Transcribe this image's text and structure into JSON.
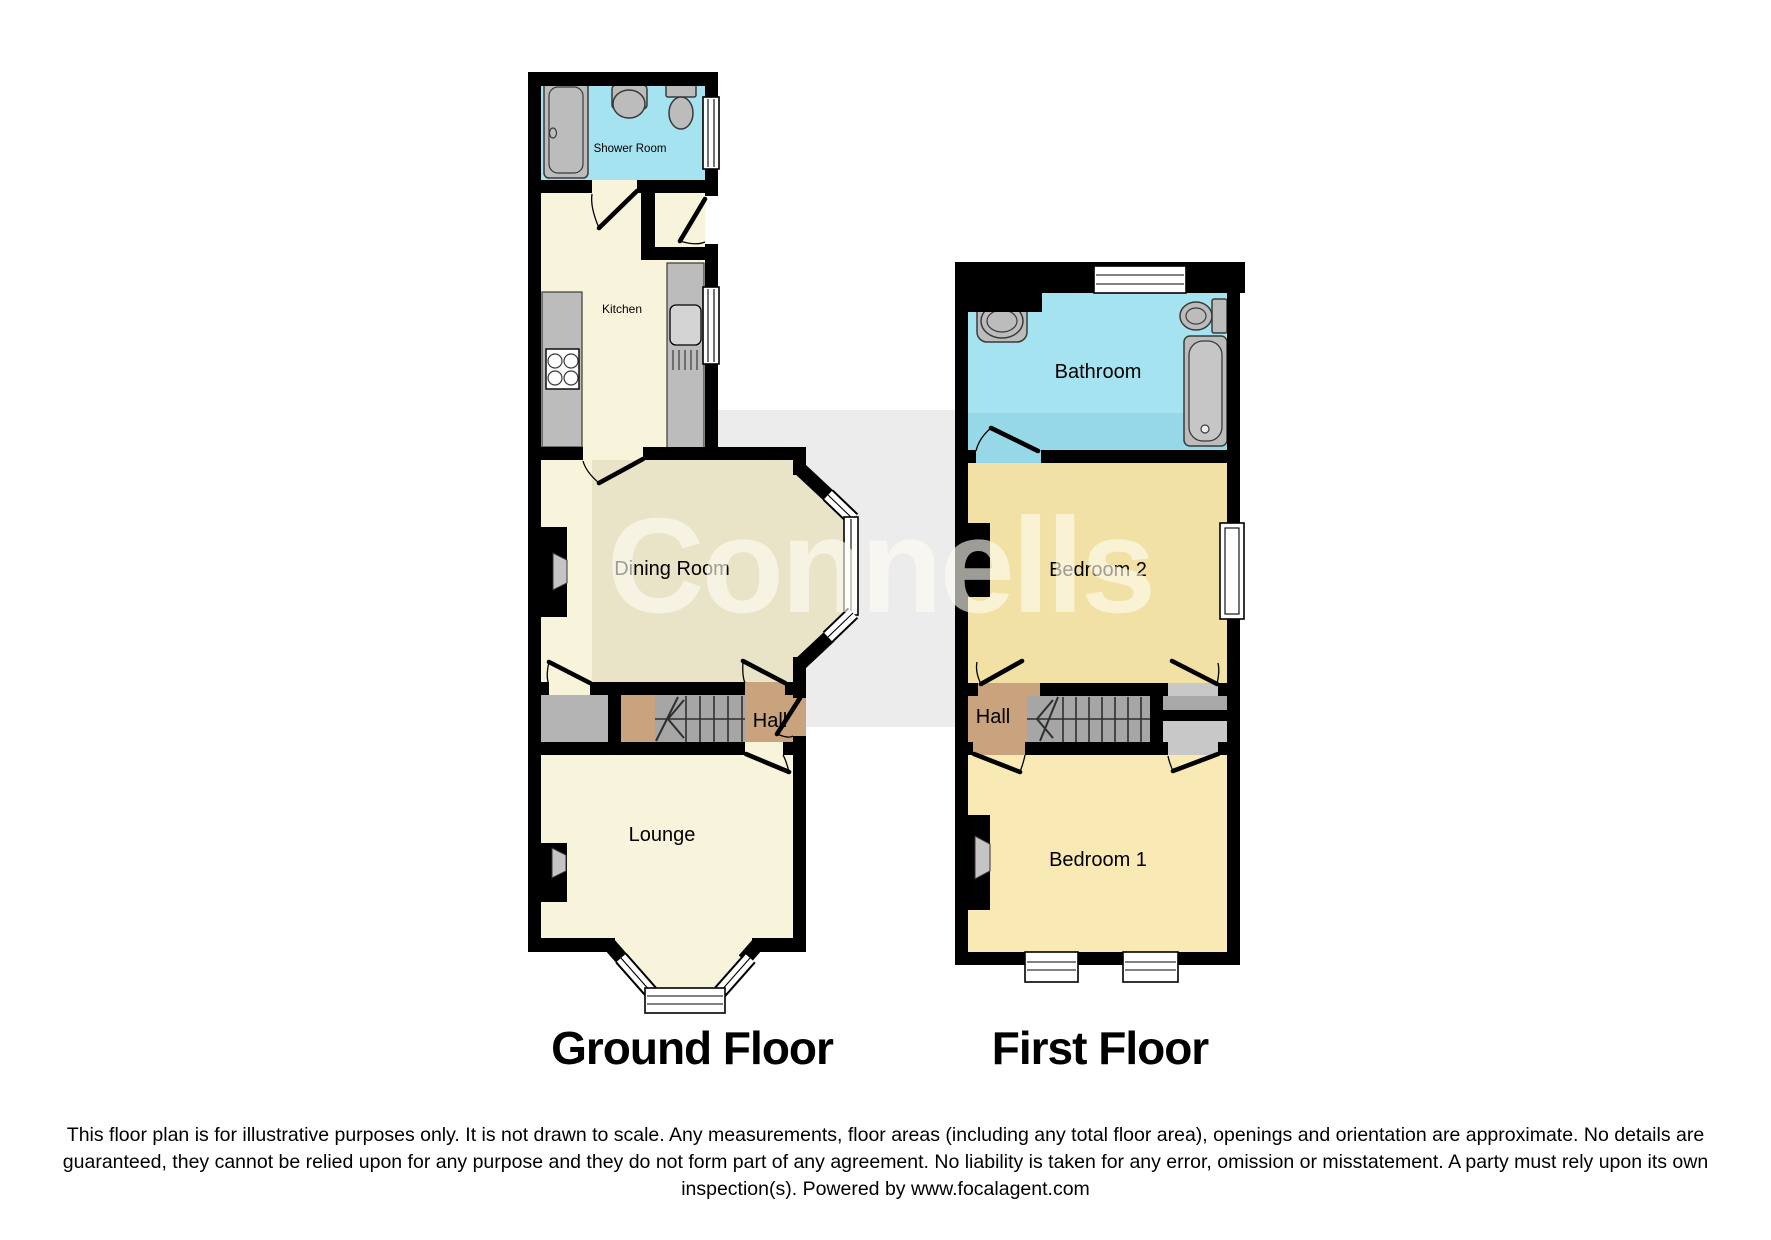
{
  "watermark": {
    "text": "Connells"
  },
  "floors": {
    "ground": {
      "title": "Ground Floor",
      "rooms": {
        "shower_room": "Shower Room",
        "kitchen": "Kitchen",
        "dining_room": "Dining Room",
        "hall": "Hall",
        "lounge": "Lounge"
      }
    },
    "first": {
      "title": "First Floor",
      "rooms": {
        "bathroom": "Bathroom",
        "bedroom2": "Bedroom 2",
        "hall": "Hall",
        "bedroom1": "Bedroom 1"
      }
    }
  },
  "fixture_icons": [
    "shower-tray",
    "basin",
    "toilet",
    "hob",
    "kitchen-sink",
    "bath",
    "stairs",
    "fireplace",
    "window",
    "door"
  ],
  "disclaimer": "This floor plan is for illustrative purposes only. It is not drawn to scale. Any measurements, floor areas (including any total floor area), openings and orientation are approximate. No details are guaranteed, they cannot be relied upon for any purpose and they do not form part of any agreement. No liability is taken for any error, omission or misstatement. A party must rely upon its own inspection(s). Powered by www.focalagent.com",
  "colors": {
    "wall": "#000000",
    "cream": "#f8f4dc",
    "khaki": "#e9e4c8",
    "cyan": "#a5e3f0",
    "cyan2": "#96d8e8",
    "bed1": "#f9e9b4",
    "bed2": "#f2e1a4",
    "tan": "#c9a37e",
    "stair": "#a6a6a6",
    "porch": "#b4b4b4",
    "land1": "#a8a8a8",
    "land2": "#c8c8c8",
    "fixture": "#bcbcbc",
    "band": "#ececec",
    "wm": "rgba(255,252,242,0.62)"
  }
}
